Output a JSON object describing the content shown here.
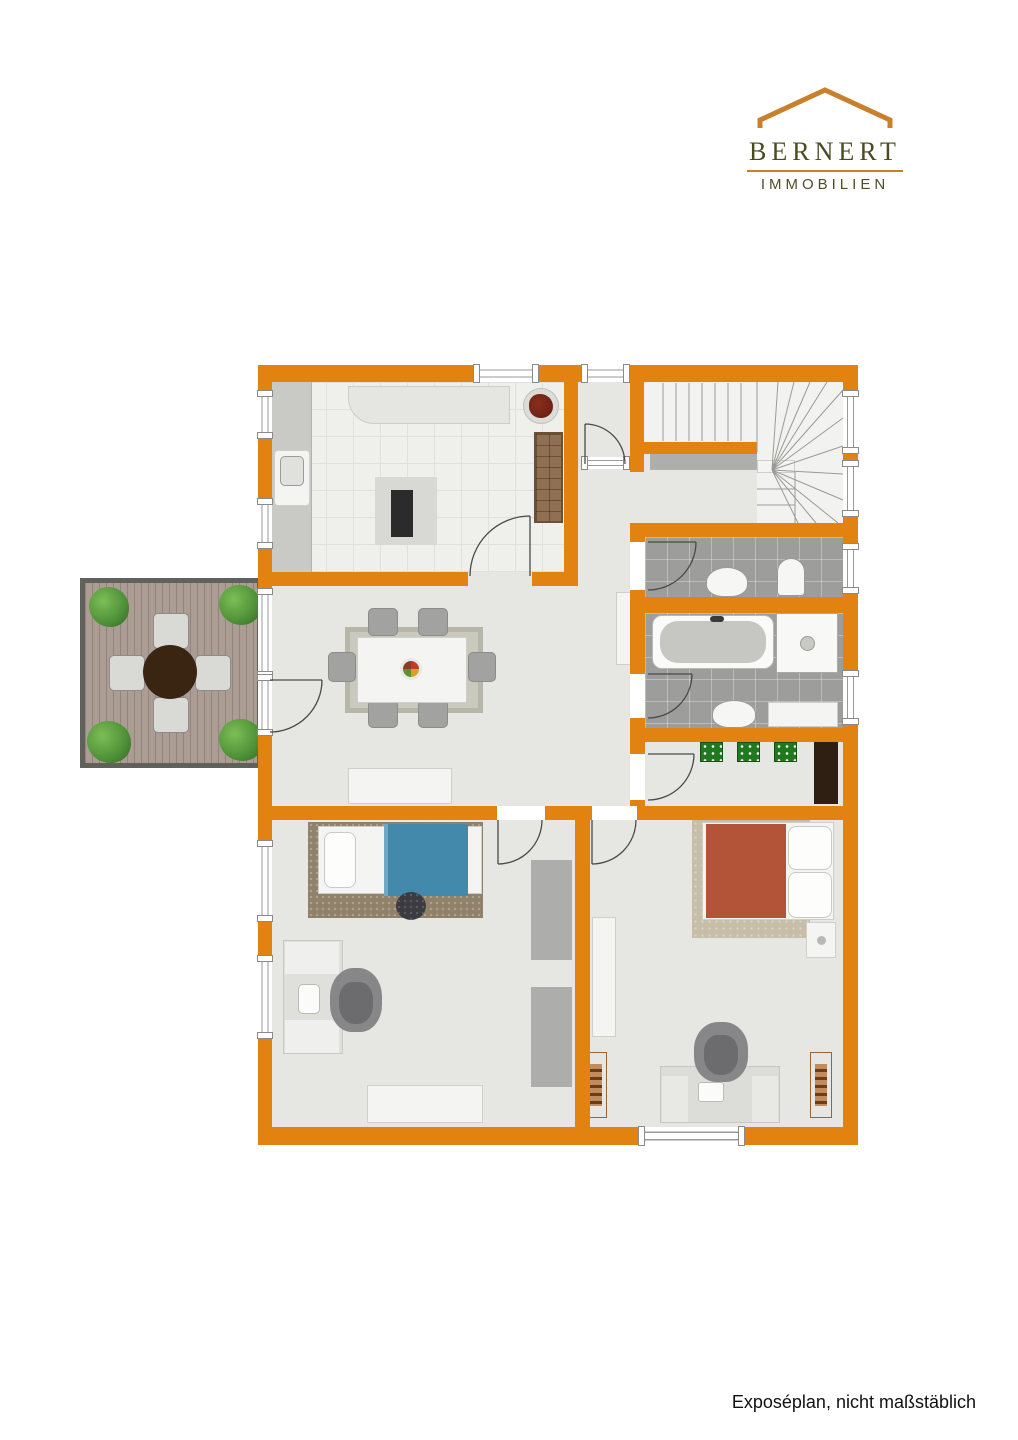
{
  "brand": {
    "name": "BERNERT",
    "subtitle": "IMMOBILIEN",
    "colors": {
      "text": "#4B4B21",
      "roof": "#C8802B",
      "rule": "#C8802B"
    }
  },
  "footer": {
    "note": "Exposéplan, nicht maßstäblich"
  },
  "plan": {
    "colors": {
      "wall": "#E28210",
      "floor": "#E6E6E3",
      "bath_tile": "#9D9D9B",
      "terrace_deck": "#AC9D94",
      "bed_blanket_blue": "#4289AC",
      "bed_blanket_red": "#B35338",
      "doormat_green": "#1F7A1F"
    },
    "rooms": [
      {
        "id": "kitchen",
        "features": [
          "counter",
          "sink",
          "cooking-island",
          "wall-counter",
          "shelf-cabinet",
          "plant"
        ]
      },
      {
        "id": "entrance-hall",
        "features": [
          "entrance-door"
        ]
      },
      {
        "id": "stairwell",
        "features": [
          "straight-stairs",
          "winding-stairs",
          "landing"
        ]
      },
      {
        "id": "wc",
        "features": [
          "washbasin",
          "toilet"
        ]
      },
      {
        "id": "bathroom",
        "features": [
          "bathtub",
          "shower",
          "washbasin",
          "counter"
        ]
      },
      {
        "id": "corridor",
        "features": [
          "three-doormats",
          "dark-wardrobe"
        ]
      },
      {
        "id": "living-dining-room",
        "features": [
          "dining-table",
          "six-chairs",
          "fruit-bowl",
          "rug",
          "sideboard",
          "cabinet",
          "terrace-door"
        ]
      },
      {
        "id": "terrace",
        "features": [
          "wood-deck",
          "round-table",
          "four-chairs",
          "four-shrubs"
        ]
      },
      {
        "id": "bedroom-left",
        "features": [
          "single-bed-blue",
          "rug",
          "ottoman",
          "desk",
          "office-chair",
          "two-wardrobes",
          "sideboard",
          "two-windows"
        ]
      },
      {
        "id": "bedroom-right",
        "features": [
          "double-bed-red",
          "rug",
          "nightstand",
          "wardrobe",
          "desk",
          "office-chair",
          "two-wooden-dressers",
          "window"
        ]
      }
    ]
  }
}
